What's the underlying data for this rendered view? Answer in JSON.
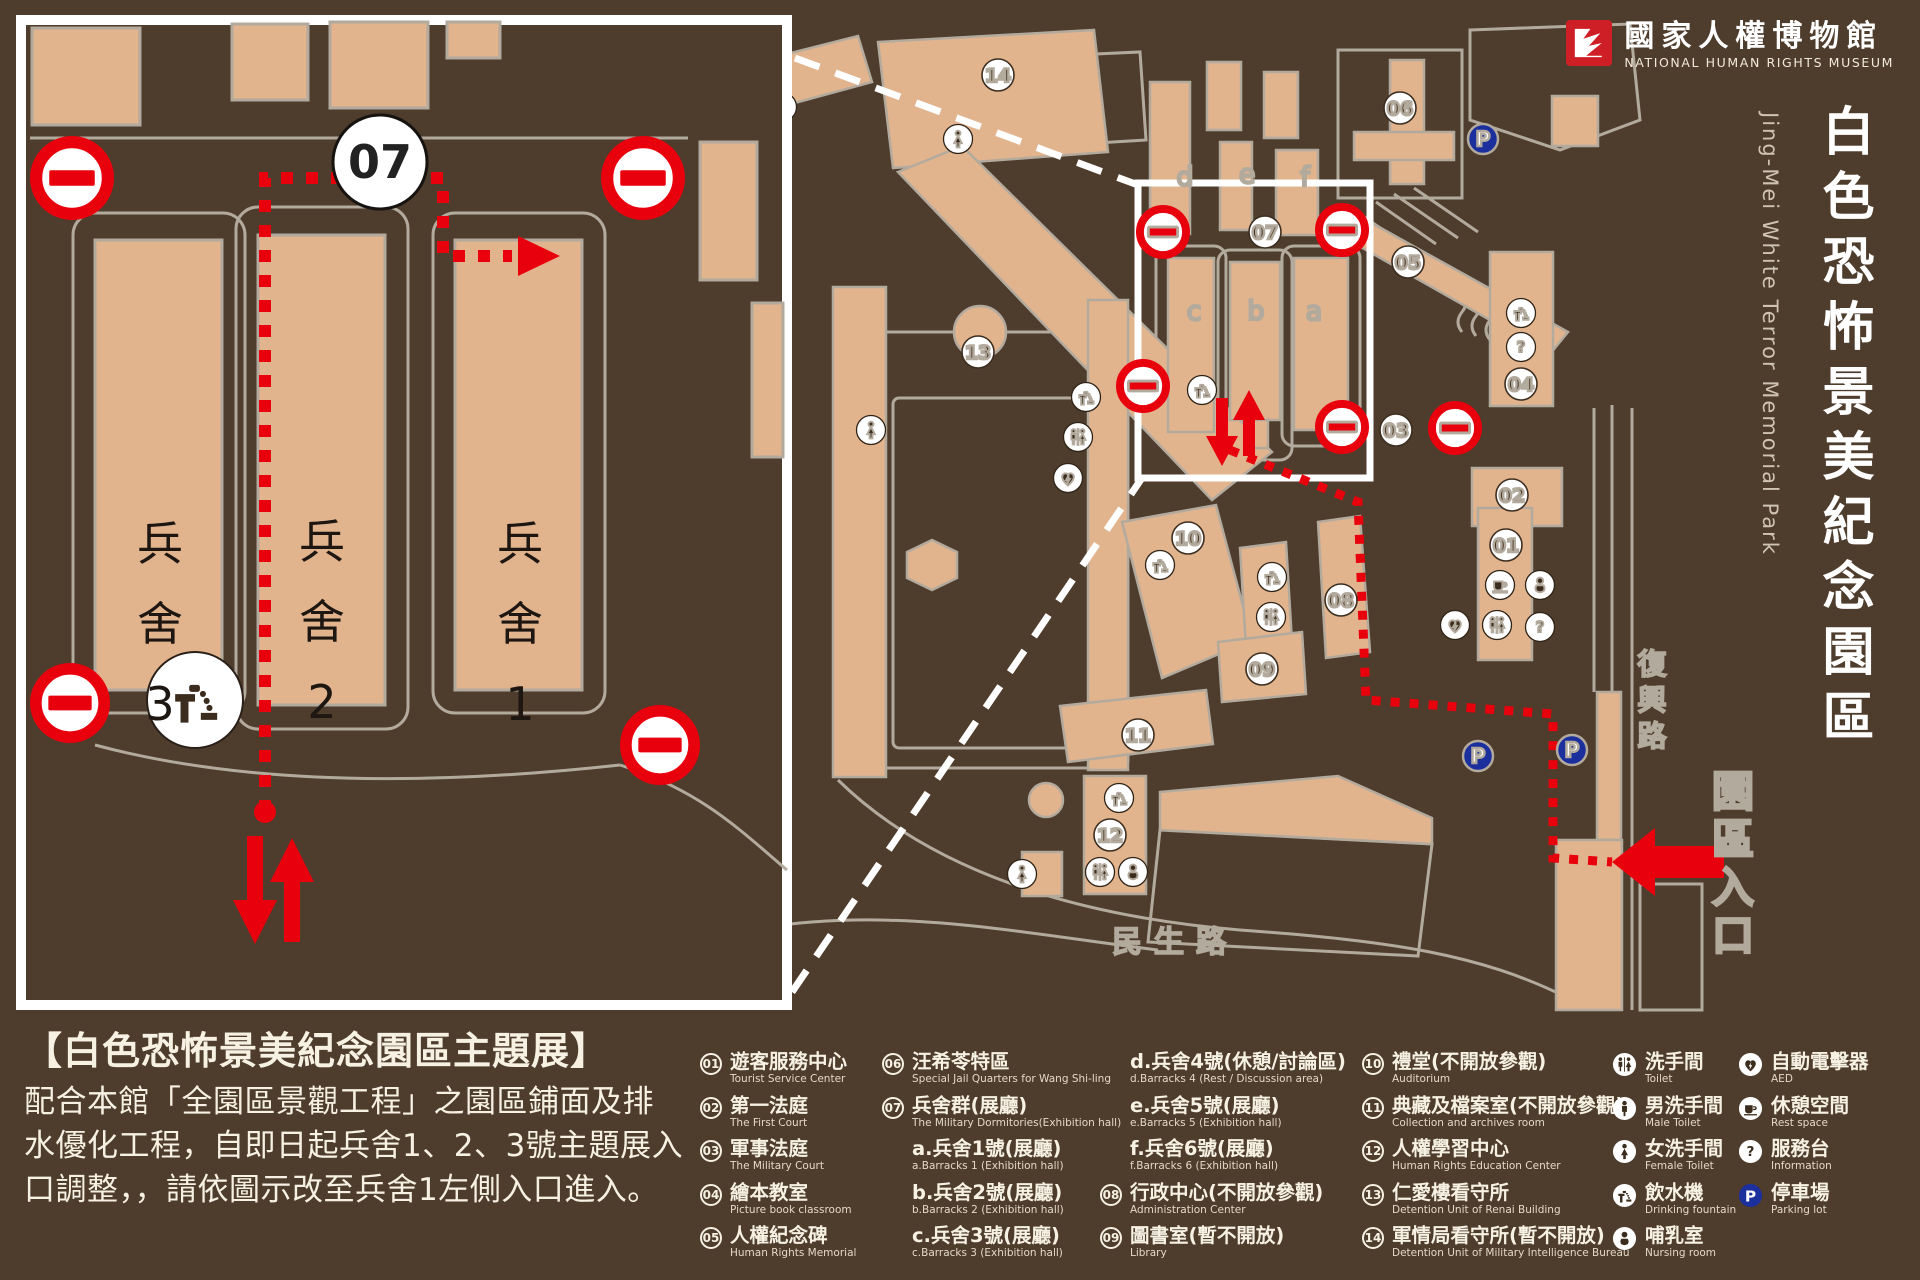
{
  "logo": {
    "museum_zh": "國家人權博物館",
    "museum_en": "NATIONAL HUMAN RIGHTS MUSEUM"
  },
  "side_title": {
    "zh": "白色恐怖景美紀念園區",
    "en": "Jing-Mei White Terror Memorial Park"
  },
  "notice": {
    "heading": "【白色恐怖景美紀念園區主題展】",
    "body": "配合本館「全園區景觀工程」之園區鋪面及排水優化工程，自即日起兵舍1、2、3號主題展入口調整，，請依圖示改至兵舍1左側入口進入。"
  },
  "colors": {
    "background": "#4e3c2c",
    "building": "#e2b48e",
    "road_line": "#b3aa9e",
    "no_entry_red": "#e8000d",
    "route_red": "#e8000d",
    "parking_blue": "#1b2f9d",
    "map_text_dark": "#4a3826",
    "label_grey": "#a39888",
    "text_cream": "#f7f1e4"
  },
  "inset": {
    "marker_label": "07",
    "marker": {
      "x": 380,
      "y": 162
    },
    "barracks": [
      {
        "label": "兵舍3",
        "x": 160,
        "y": 560
      },
      {
        "label": "兵舍2",
        "x": 322,
        "y": 558
      },
      {
        "label": "兵舍1",
        "x": 520,
        "y": 560
      }
    ]
  },
  "map": {
    "entrance_label": "園區入口",
    "entrance_pos": {
      "x": 1733,
      "y": 772
    },
    "road_labels": {
      "minsheng": {
        "text": "民生路",
        "x": 1112,
        "y": 952
      },
      "fuxing": {
        "text": "復興路",
        "x": 1652,
        "y": 652
      }
    },
    "number_markers": [
      {
        "label": "01",
        "x": 1506,
        "y": 545
      },
      {
        "label": "02",
        "x": 1512,
        "y": 495
      },
      {
        "label": "03",
        "x": 1396,
        "y": 430
      },
      {
        "label": "04",
        "x": 1521,
        "y": 384
      },
      {
        "label": "05",
        "x": 1408,
        "y": 262
      },
      {
        "label": "06",
        "x": 1400,
        "y": 108
      },
      {
        "label": "07",
        "x": 1265,
        "y": 232
      },
      {
        "label": "08",
        "x": 1341,
        "y": 600
      },
      {
        "label": "09",
        "x": 1262,
        "y": 669
      },
      {
        "label": "10",
        "x": 1188,
        "y": 538
      },
      {
        "label": "11",
        "x": 1138,
        "y": 735
      },
      {
        "label": "12",
        "x": 1110,
        "y": 835
      },
      {
        "label": "13",
        "x": 978,
        "y": 352
      },
      {
        "label": "14",
        "x": 998,
        "y": 75
      }
    ],
    "letter_markers": [
      {
        "label": "d",
        "x": 1185,
        "y": 186
      },
      {
        "label": "e",
        "x": 1247,
        "y": 183
      },
      {
        "label": "f",
        "x": 1305,
        "y": 186
      },
      {
        "label": "c",
        "x": 1194,
        "y": 320
      },
      {
        "label": "b",
        "x": 1256,
        "y": 320
      },
      {
        "label": "a",
        "x": 1314,
        "y": 320
      }
    ],
    "icon_markers": [
      {
        "icon": "person",
        "x": 782,
        "y": 107
      },
      {
        "icon": "person-f",
        "x": 958,
        "y": 139
      },
      {
        "icon": "person-f",
        "x": 871,
        "y": 430
      },
      {
        "icon": "fountain",
        "x": 1202,
        "y": 390
      },
      {
        "icon": "fountain",
        "x": 1086,
        "y": 397
      },
      {
        "icon": "toilet",
        "x": 1078,
        "y": 437
      },
      {
        "icon": "aed",
        "x": 1068,
        "y": 478
      },
      {
        "icon": "fountain",
        "x": 1521,
        "y": 313
      },
      {
        "icon": "info",
        "x": 1521,
        "y": 347
      },
      {
        "icon": "fountain",
        "x": 1160,
        "y": 565
      },
      {
        "icon": "fountain",
        "x": 1272,
        "y": 577
      },
      {
        "icon": "toilet",
        "x": 1271,
        "y": 617
      },
      {
        "icon": "fountain",
        "x": 1119,
        "y": 798
      },
      {
        "icon": "toilet",
        "x": 1100,
        "y": 872
      },
      {
        "icon": "baby",
        "x": 1133,
        "y": 872
      },
      {
        "icon": "person-f",
        "x": 1022,
        "y": 874
      },
      {
        "icon": "rest",
        "x": 1500,
        "y": 585
      },
      {
        "icon": "baby",
        "x": 1540,
        "y": 585
      },
      {
        "icon": "aed",
        "x": 1455,
        "y": 625
      },
      {
        "icon": "toilet",
        "x": 1497,
        "y": 625
      },
      {
        "icon": "info",
        "x": 1540,
        "y": 627
      }
    ],
    "parking_markers": [
      {
        "label": "P",
        "x": 1483,
        "y": 139
      },
      {
        "label": "P",
        "x": 1478,
        "y": 756
      },
      {
        "label": "P",
        "x": 1572,
        "y": 750
      }
    ]
  },
  "legend": {
    "columns": [
      {
        "left": 700,
        "items": [
          {
            "badge": "01",
            "zh": "遊客服務中心",
            "en": "Tourist Service Center"
          },
          {
            "badge": "02",
            "zh": "第一法庭",
            "en": "The First Court"
          },
          {
            "badge": "03",
            "zh": "軍事法庭",
            "en": "The Military Court"
          },
          {
            "badge": "04",
            "zh": "繪本教室",
            "en": "Picture book classroom"
          },
          {
            "badge": "05",
            "zh": "人權紀念碑",
            "en": "Human Rights Memorial"
          }
        ]
      },
      {
        "left": 882,
        "items": [
          {
            "badge": "06",
            "zh": "汪希苓特區",
            "en": "Special Jail Quarters for Wang Shi-ling"
          },
          {
            "badge": "07",
            "zh": "兵舍群(展廳)",
            "en": "The Military Dormitories(Exhibition hall)"
          },
          {
            "zh": "a.兵舍1號(展廳)",
            "en": "a.Barracks 1 (Exhibition hall)"
          },
          {
            "zh": "b.兵舍2號(展廳)",
            "en": "b.Barracks 2 (Exhibition hall)"
          },
          {
            "zh": "c.兵舍3號(展廳)",
            "en": "c.Barracks 3 (Exhibition hall)"
          }
        ]
      },
      {
        "left": 1100,
        "items": [
          {
            "zh": "d.兵舍4號(休憩/討論區)",
            "en": "d.Barracks 4 (Rest / Discussion area)"
          },
          {
            "zh": "e.兵舍5號(展廳)",
            "en": "e.Barracks 5 (Exhibition hall)"
          },
          {
            "zh": "f.兵舍6號(展廳)",
            "en": "f.Barracks 6 (Exhibition hall)"
          },
          {
            "badge": "08",
            "zh": "行政中心(不開放參觀)",
            "en": "Administration Center"
          },
          {
            "badge": "09",
            "zh": "圖書室(暫不開放)",
            "en": "Library"
          }
        ]
      },
      {
        "left": 1362,
        "items": [
          {
            "badge": "10",
            "zh": "禮堂(不開放參觀)",
            "en": "Auditorium"
          },
          {
            "badge": "11",
            "zh": "典藏及檔案室(不開放參觀)",
            "en": "Collection and archives room"
          },
          {
            "badge": "12",
            "zh": "人權學習中心",
            "en": "Human Rights Education Center"
          },
          {
            "badge": "13",
            "zh": "仁愛樓看守所",
            "en": "Detention Unit of Renai Building"
          },
          {
            "badge": "14",
            "zh": "軍情局看守所(暫不開放)",
            "en": "Detention Unit of Military Intelligence Bureau"
          }
        ]
      },
      {
        "left": 1612,
        "items": [
          {
            "icon": "toilet",
            "zh": "洗手間",
            "en": "Toilet"
          },
          {
            "icon": "person",
            "zh": "男洗手間",
            "en": "Male Toilet"
          },
          {
            "icon": "person-f",
            "zh": "女洗手間",
            "en": "Female Toilet"
          },
          {
            "icon": "fountain",
            "zh": "飲水機",
            "en": "Drinking fountain"
          },
          {
            "icon": "baby",
            "zh": "哺乳室",
            "en": "Nursing room"
          }
        ]
      },
      {
        "left": 1738,
        "items": [
          {
            "icon": "aed",
            "zh": "自動電擊器",
            "en": "AED"
          },
          {
            "icon": "rest",
            "zh": "休憩空間",
            "en": "Rest space"
          },
          {
            "icon": "info",
            "zh": "服務台",
            "en": "Information"
          },
          {
            "icon": "parking",
            "zh": "停車場",
            "en": "Parking lot"
          }
        ]
      }
    ]
  }
}
